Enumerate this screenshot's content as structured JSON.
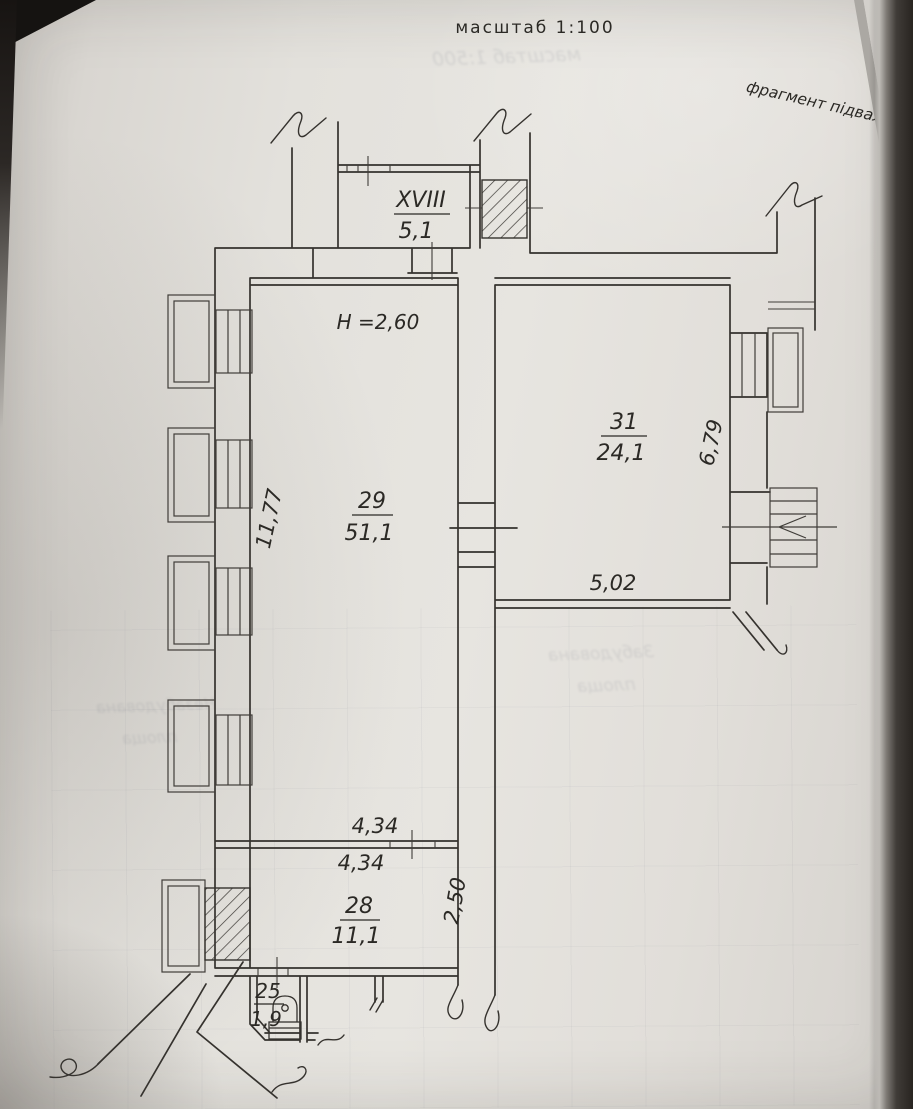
{
  "plan": {
    "scale_label": "масштаб 1:100",
    "fragment_label": "фрагмент підвалу",
    "ceiling_height_label": "H =2,60"
  },
  "rooms": [
    {
      "number": "XVIII",
      "area": "5,1"
    },
    {
      "number": "29",
      "area": "51,1"
    },
    {
      "number": "31",
      "area": "24,1"
    },
    {
      "number": "28",
      "area": "11,1"
    },
    {
      "number": "25",
      "area": "1,9"
    }
  ],
  "dimensions": {
    "left_wall": "11,77",
    "right_room_depth": "6,79",
    "room31_bottom_width": "5,02",
    "partition_above": "4,34",
    "partition_below": "4,34",
    "room28_depth": "2,50"
  },
  "bleedthrough": {
    "scale_line": "масштаб 1:500",
    "word1": "Забудована",
    "word2": "площа",
    "word3": "Незабудована",
    "word4": "площа"
  },
  "colors": {
    "ink": "#35322e",
    "paper": "#e2dfda"
  }
}
